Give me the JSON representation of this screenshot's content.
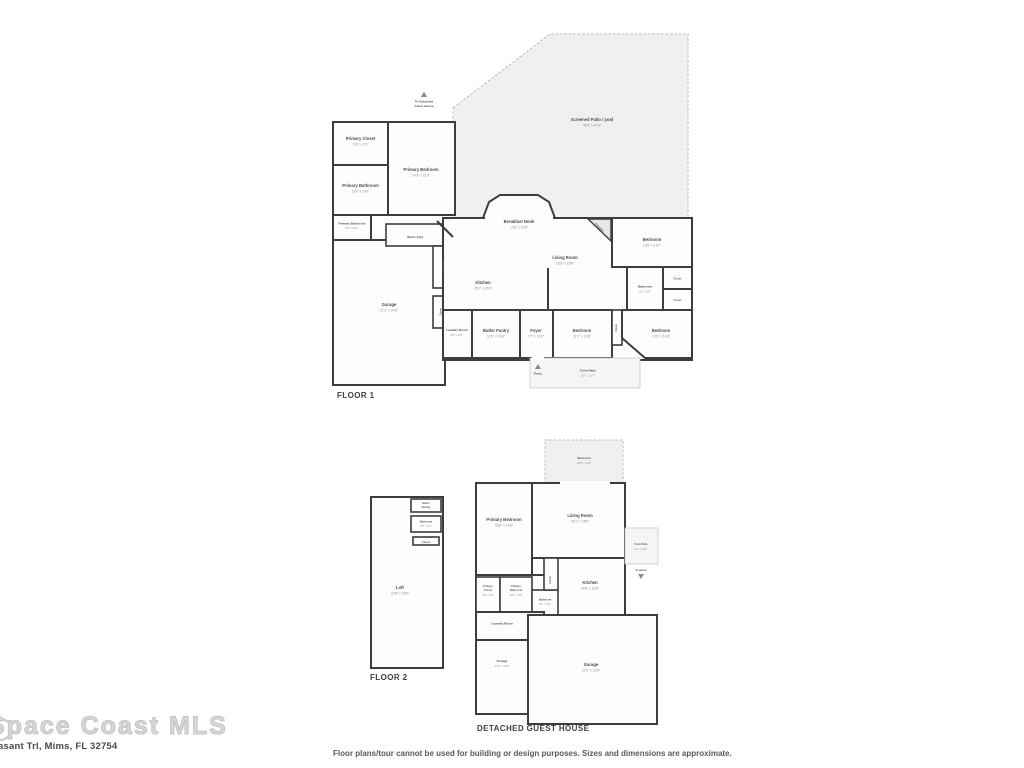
{
  "watermark": {
    "logo": "Space Coast MLS",
    "address": "asant Trl, Mims, FL 32754",
    "disclaimer": "Floor plans/tour cannot be used for building or design purposes. Sizes and dimensions are approximate."
  },
  "colors": {
    "wall": "#3d3d3d",
    "room_fill": "#fdfdfd",
    "patio_fill": "#f1f1f1",
    "label": "#4d4d4d",
    "dim": "#8f8f8f"
  },
  "floor1": {
    "title": "FLOOR 1",
    "patio": {
      "name": "Screened Patio / pool",
      "dim": "46'8\" x 41'8\""
    },
    "to_guest_l1": "To Detached",
    "to_guest_l2": "Guest House",
    "entry": "Entry",
    "front_patio": {
      "name": "Front Patio",
      "dim": "28'7\" x 10'7\""
    },
    "rooms": {
      "primary_closet": {
        "name": "Primary Closet",
        "dim": "11'8\" x 6'8\""
      },
      "primary_bathroom": {
        "name": "Primary Bathroom",
        "dim": "11'8\" x 14'5\""
      },
      "primary_bathroom2": {
        "name": "Primary Bathroom",
        "dim": "6'8\" x 5'10\""
      },
      "primary_bedroom": {
        "name": "Primary Bedroom",
        "dim": "14'9\" x 21'9\""
      },
      "stairs": {
        "name": "Stairs (Up)"
      },
      "garage": {
        "name": "Garage",
        "dim": "21'3\" x 24'8\""
      },
      "bathroom_small": {
        "name": "Bathroom",
        "dim": "5'8\" x 7'5\""
      },
      "closet_small": {
        "name": "Closet"
      },
      "kitchen": {
        "name": "Kitchen",
        "dim": "15'1\" x 15'9\""
      },
      "breakfast_nook": {
        "name": "Breakfast Nook",
        "dim": "12'8\" x 10'9\""
      },
      "living_room": {
        "name": "Living Room",
        "dim": "16'8\" x 18'8\""
      },
      "laundry": {
        "name": "Laundry Room",
        "dim": "9'8\" x 13'1\""
      },
      "butler_pantry": {
        "name": "Butler Pantry",
        "dim": "12'9\" x 14'8\""
      },
      "foyer": {
        "name": "Foyer",
        "dim": "7'2\" x 13'8\""
      },
      "bedroom_center": {
        "name": "Bedroom",
        "dim": "11'2\" x 13'8\""
      },
      "bedroom_topright": {
        "name": "Bedroom",
        "dim": "13'8\" x 13'7\""
      },
      "bathroom_right": {
        "name": "Bathroom",
        "dim": "9'2\" x 8'8\""
      },
      "closet_a": {
        "name": "Closet"
      },
      "closet_b": {
        "name": "Closet"
      },
      "closet_mid": {
        "name": "Closet"
      },
      "bedroom_bottomright": {
        "name": "Bedroom",
        "dim": "13'9\" x 14'8\""
      },
      "fireplace": {
        "name": "Fireplace"
      }
    }
  },
  "floor2": {
    "title": "FLOOR 2",
    "rooms": {
      "stairs_l1": "Stairs",
      "stairs_l2": "(Down)",
      "bathroom": {
        "name": "Bathroom",
        "dim": "5'8\" x 8'1\""
      },
      "closet": {
        "name": "Closet"
      },
      "loft": {
        "name": "Loft",
        "dim": "10'8\" x 29'9\""
      }
    }
  },
  "guest": {
    "title": "DETACHED GUEST HOUSE",
    "rooms": {
      "sunroom": {
        "name": "Sunroom",
        "dim": "16'8\" x 9'11\""
      },
      "primary_bedroom": {
        "name": "Primary Bedroom",
        "dim": "16'8\" x 14'8\""
      },
      "living_room": {
        "name": "Living Room",
        "dim": "20'1\" x 18'8\""
      },
      "from_patio": {
        "name": "From Patio",
        "dim": "8'1\" x 10'1\""
      },
      "to_house": {
        "name": "To House"
      },
      "kitchen": {
        "name": "Kitchen",
        "dim": "14'8\" x 13'8\""
      },
      "closet": {
        "name": "Closet"
      },
      "primary_closet": {
        "l1": "Primary",
        "l2": "Closet",
        "dim": "4'8\" x 7'5\""
      },
      "primary_bathroom": {
        "l1": "Primary",
        "l2": "Bathroom",
        "dim": "10'1\" x 8'8\""
      },
      "bathroom": {
        "name": "Bathroom",
        "dim": "8'1\" x 5'8\""
      },
      "laundry": {
        "name": "Laundry Room"
      },
      "garage_small": {
        "name": "Garage",
        "dim": "10'8\" x 21'8\""
      },
      "garage_large": {
        "name": "Garage",
        "dim": "21'8\" x 22'8\""
      }
    }
  }
}
